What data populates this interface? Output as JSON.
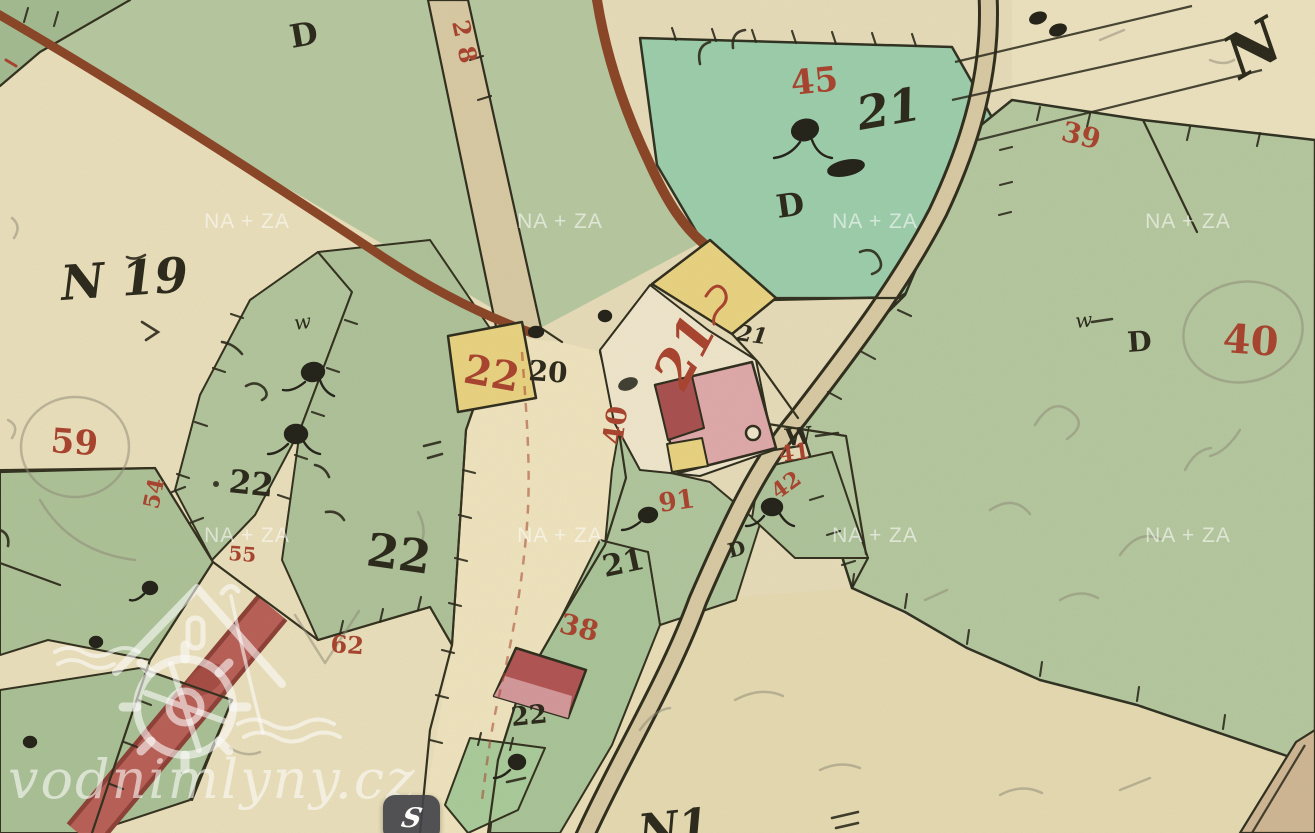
{
  "map": {
    "labels": {
      "d_top": "D",
      "p28_road": "28",
      "p45": "45",
      "p21_script": "21",
      "d_teal": "D",
      "p39": "39",
      "n_topright": "N",
      "n19": "N 19",
      "p59": "59",
      "w_left": "w",
      "p22_dot": "22",
      "p54": "54",
      "p55": "55",
      "p22_big": "22",
      "p62": "62",
      "p22_yellow": "22",
      "p20": "20",
      "p21_yellow_small": "21",
      "p21_red": "21",
      "p40_vert": "40",
      "w_mid": "W",
      "p41": "41",
      "p42": "42",
      "p91": "91",
      "d_small": "D",
      "p21_mid": "21",
      "p38": "38",
      "p22_bottom": "22",
      "w_right": "w",
      "d_right": "D",
      "p40_right": "40",
      "n1_bottom": "N1"
    },
    "colors": {
      "red_ink": "#a8432f",
      "black_ink": "#2b291c",
      "paper": "#e7dcba",
      "green_light": "#b5c8a0",
      "green_teal": "#9cceac",
      "road_tan": "#d8caa4",
      "road_crimson": "#b85f57",
      "building_pink": "#dfa9ab",
      "building_yellow": "#e9d382",
      "building_red": "#b05454",
      "line_brown": "#8a4527",
      "pencil": "#8d8977",
      "watermark": "rgba(255,255,255,0.6)"
    }
  },
  "watermark": {
    "tile_text": "NA + ZA",
    "site_text": "vodnimlyny.cz"
  },
  "chat_widget": {
    "label": "S"
  }
}
